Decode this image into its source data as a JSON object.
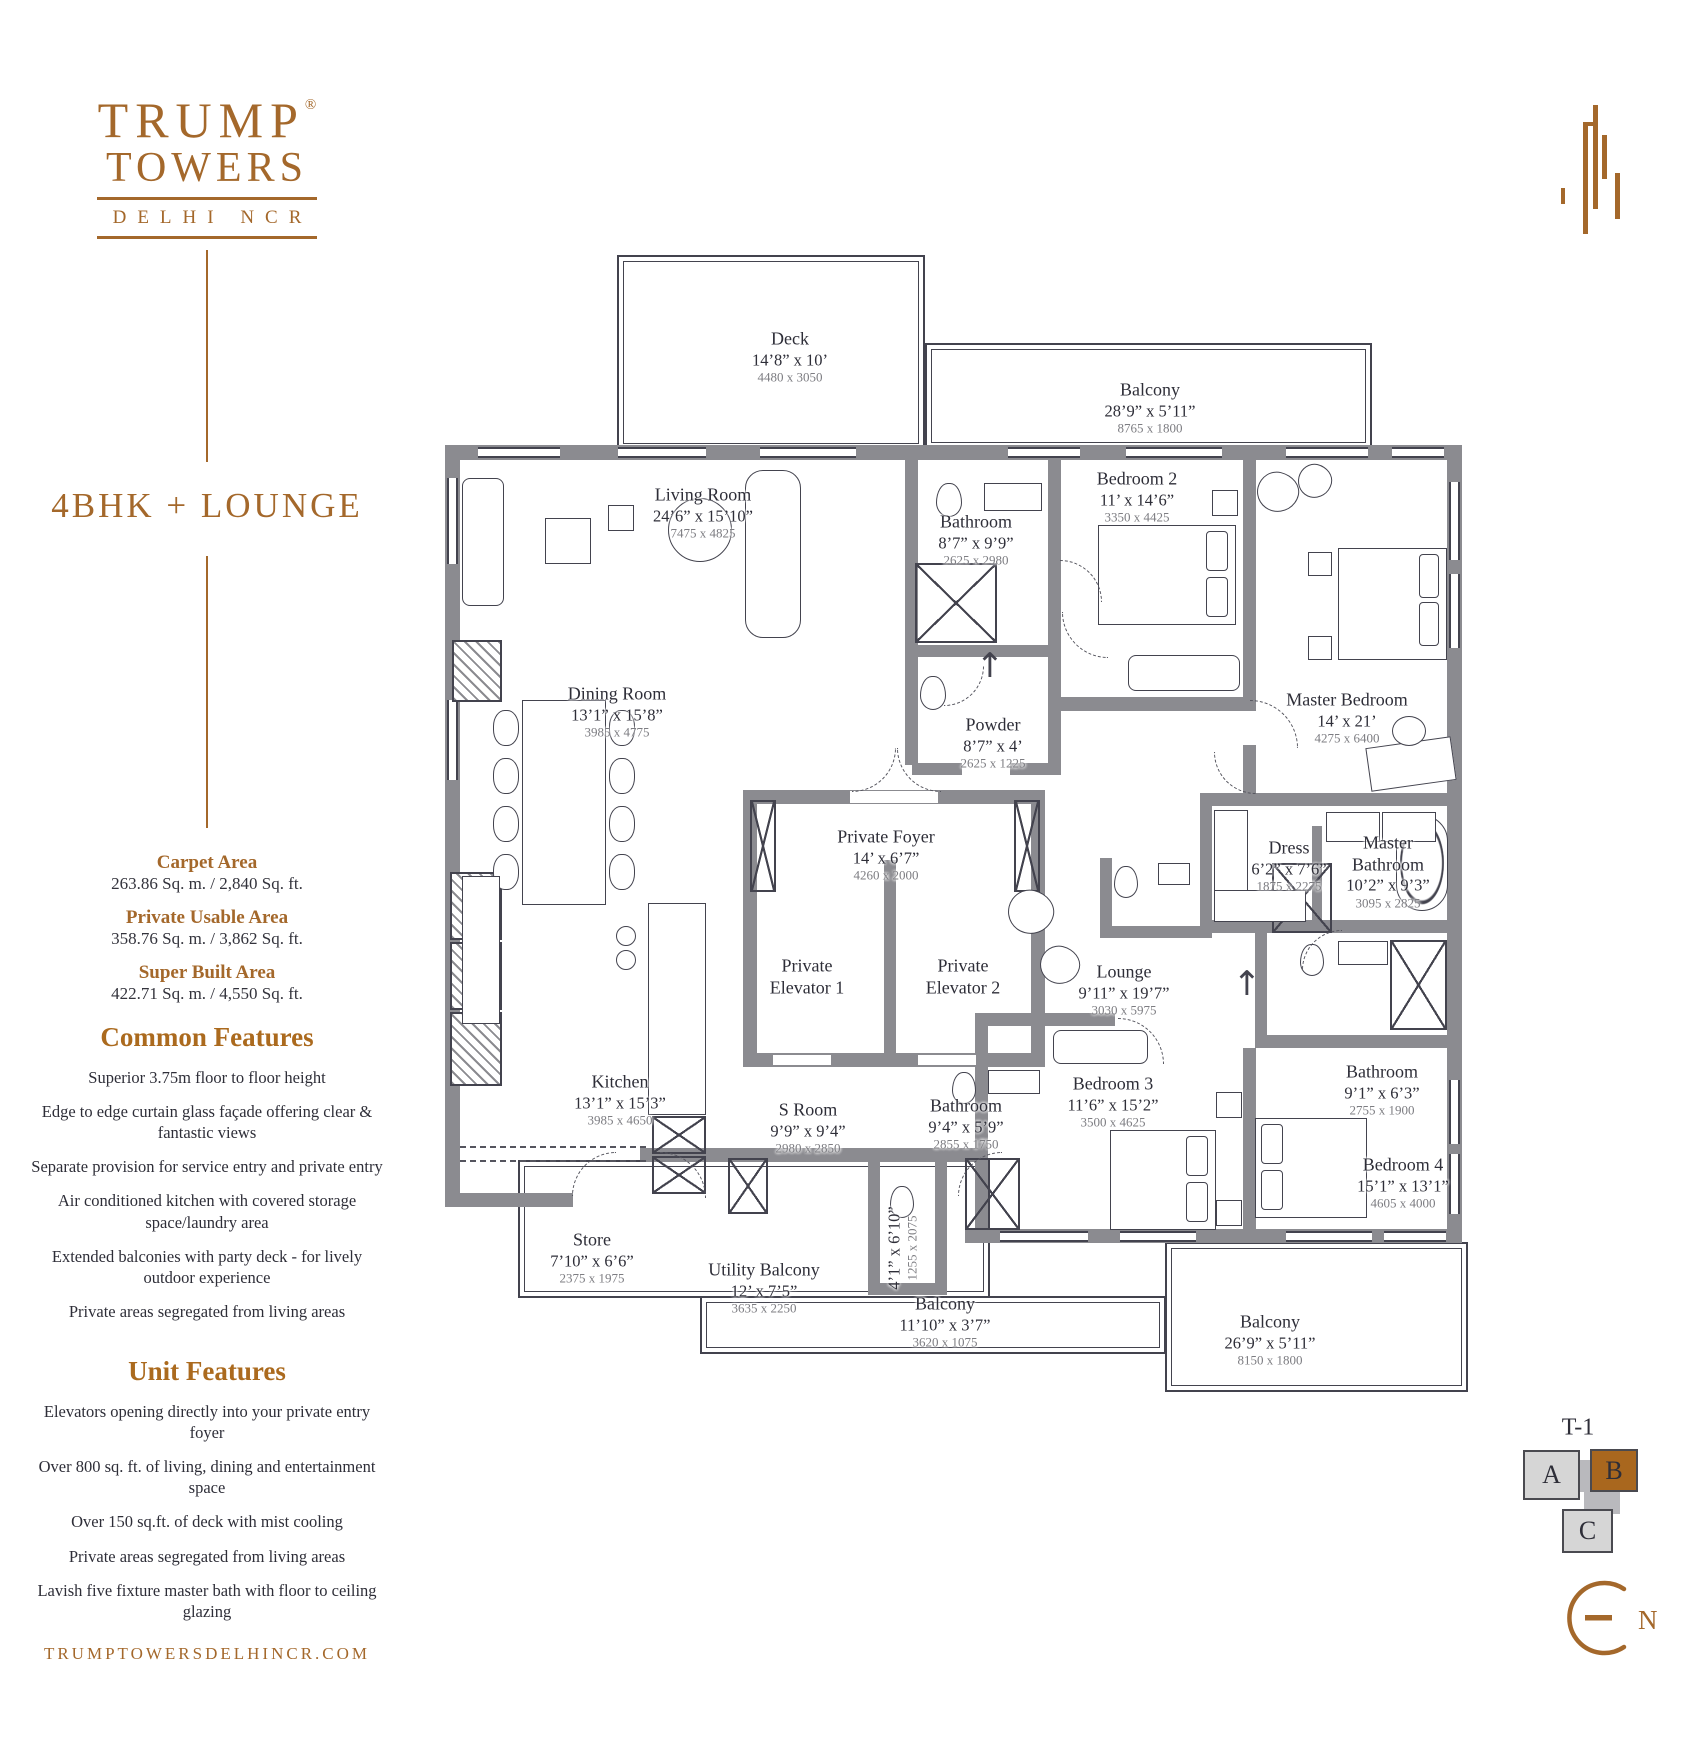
{
  "brand": {
    "trump": "TRUMP",
    "registered": "®",
    "towers": "TOWERS",
    "sub": "DELHI NCR"
  },
  "unit_title": "4BHK + LOUNGE",
  "areas": [
    {
      "label": "Carpet Area",
      "value": "263.86 Sq. m. / 2,840 Sq. ft."
    },
    {
      "label": "Private Usable Area",
      "value": "358.76 Sq. m. / 3,862 Sq. ft."
    },
    {
      "label": "Super Built Area",
      "value": "422.71 Sq. m. / 4,550 Sq. ft."
    }
  ],
  "common_features": {
    "heading": "Common Features",
    "items": [
      "Superior 3.75m floor to floor height",
      "Edge to edge curtain glass façade offering clear & fantastic views",
      "Separate provision for service entry and private entry",
      "Air conditioned kitchen with covered storage space/laundry area",
      "Extended balconies with party deck - for lively outdoor experience",
      "Private areas segregated from living areas"
    ]
  },
  "unit_features": {
    "heading": "Unit Features",
    "items": [
      "Elevators opening directly into your private entry foyer",
      "Over 800 sq. ft. of living, dining and entertainment space",
      "Over 150 sq.ft. of deck with mist cooling",
      "Private areas segregated from living areas",
      "Lavish five fixture master bath with floor to ceiling glazing"
    ]
  },
  "website": "TRUMPTOWERSDELHINCR.COM",
  "unit_key": {
    "tower": "T-1",
    "units": [
      {
        "label": "A",
        "highlighted": false
      },
      {
        "label": "B",
        "highlighted": true
      },
      {
        "label": "C",
        "highlighted": false
      }
    ]
  },
  "compass": {
    "label": "N"
  },
  "colors": {
    "brand_brown": "#a4682b",
    "highlight_unit": "#a9671e",
    "wall_gray": "#8b8b90"
  },
  "rooms": [
    {
      "name": "Deck",
      "ft": "14’8” x 10’",
      "mm": "4480 x 3050",
      "x": 790,
      "y": 357
    },
    {
      "name": "Balcony",
      "ft": "28’9” x 5’11”",
      "mm": "8765 x 1800",
      "x": 1150,
      "y": 408
    },
    {
      "name": "Living Room",
      "ft": "24’6” x 15’10”",
      "mm": "7475 x 4825",
      "x": 703,
      "y": 513
    },
    {
      "name": "Bathroom",
      "ft": "8’7” x 9’9”",
      "mm": "2625 x 2980",
      "x": 976,
      "y": 540
    },
    {
      "name": "Bedroom 2",
      "ft": "11’ x 14’6”",
      "mm": "3350 x 4425",
      "x": 1137,
      "y": 497
    },
    {
      "name": "Master Bedroom",
      "ft": "14’ x 21’",
      "mm": "4275 x 6400",
      "x": 1347,
      "y": 718
    },
    {
      "name": "Dining Room",
      "ft": "13’1” x 15’8”",
      "mm": "3985 x 4775",
      "x": 617,
      "y": 712
    },
    {
      "name": "Powder",
      "ft": "8’7” x 4’",
      "mm": "2625 x 1225",
      "x": 993,
      "y": 743
    },
    {
      "name": "Private Foyer",
      "ft": "14’ x 6’7”",
      "mm": "4260 x 2000",
      "x": 886,
      "y": 855
    },
    {
      "name": "Dress",
      "ft": "6’2” x 7’6”",
      "mm": "1875 x 2275",
      "x": 1289,
      "y": 866
    },
    {
      "name": "Master\nBathroom",
      "ft": "10’2” x 9’3”",
      "mm": "3095 x 2825",
      "x": 1388,
      "y": 872
    },
    {
      "name": "Private\nElevator 1",
      "x": 807,
      "y": 977
    },
    {
      "name": "Private\nElevator 2",
      "x": 963,
      "y": 977
    },
    {
      "name": "Lounge",
      "ft": "9’11” x 19’7”",
      "mm": "3030 x 5975",
      "x": 1124,
      "y": 990
    },
    {
      "name": "Kitchen",
      "ft": "13’1” x 15’3”",
      "mm": "3985 x 4650",
      "x": 620,
      "y": 1100
    },
    {
      "name": "S Room",
      "ft": "9’9” x 9’4”",
      "mm": "2980 x 2850",
      "x": 808,
      "y": 1128
    },
    {
      "name": "Bathroom",
      "ft": "9’4” x 5’9”",
      "mm": "2855 x 1750",
      "x": 966,
      "y": 1124
    },
    {
      "name": "Bedroom 3",
      "ft": "11’6” x 15’2”",
      "mm": "3500 x 4625",
      "x": 1113,
      "y": 1102
    },
    {
      "name": "Bathroom",
      "ft": "9’1” x 6’3”",
      "mm": "2755 x 1900",
      "x": 1382,
      "y": 1090
    },
    {
      "name": "Bedroom 4",
      "ft": "15’1” x 13’1”",
      "mm": "4605 x 4000",
      "x": 1403,
      "y": 1183
    },
    {
      "name": "Store",
      "ft": "7’10” x 6’6”",
      "mm": "2375 x 1975",
      "x": 592,
      "y": 1258
    },
    {
      "name": "Utility Balcony",
      "ft": "12’ x 7’5”",
      "mm": "3635 x 2250",
      "x": 764,
      "y": 1288
    },
    {
      "name": "Balcony",
      "ft": "11’10” x 3’7”",
      "mm": "3620 x 1075",
      "x": 945,
      "y": 1322
    },
    {
      "name": "Balcony",
      "ft": "26’9” x 5’11”",
      "mm": "8150 x 1800",
      "x": 1270,
      "y": 1340
    },
    {
      "name": "",
      "ft": "4’1” x 6’10”",
      "mm": "1255 x 2075",
      "x": 902,
      "y": 1248,
      "rotate": -90
    }
  ]
}
